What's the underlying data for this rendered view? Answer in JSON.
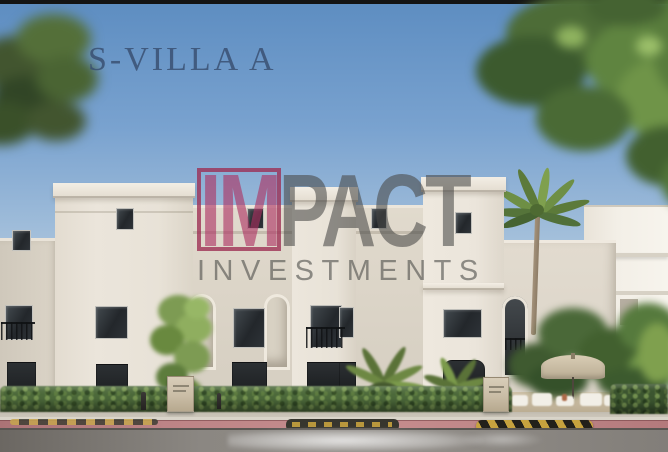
{
  "title": {
    "text": "S-VILLA A",
    "color": "#3a5072"
  },
  "watermark": {
    "im": "IM",
    "pact": "PACT",
    "subtitle": "INVESTMENTS",
    "accent_color": "#9c2d52",
    "gray_color": "#484846"
  },
  "palette": {
    "sky_top": "#5d8dc1",
    "sky_horizon": "#dde4e9",
    "facade_light": "#ebe5db",
    "facade_shaded": "#d8d1c5",
    "window_glass": "#23272b",
    "hedge_green": "#4d6a3b",
    "tree_green": "#5f8440",
    "palm_trunk": "#9b8a74",
    "bike_lane_pink": "#c68d8e",
    "speed_bump_gold": "#c7a23e",
    "asphalt_gray": "#8b8782",
    "umbrella_beige": "#cec1a7",
    "top_bar": "#141414"
  }
}
